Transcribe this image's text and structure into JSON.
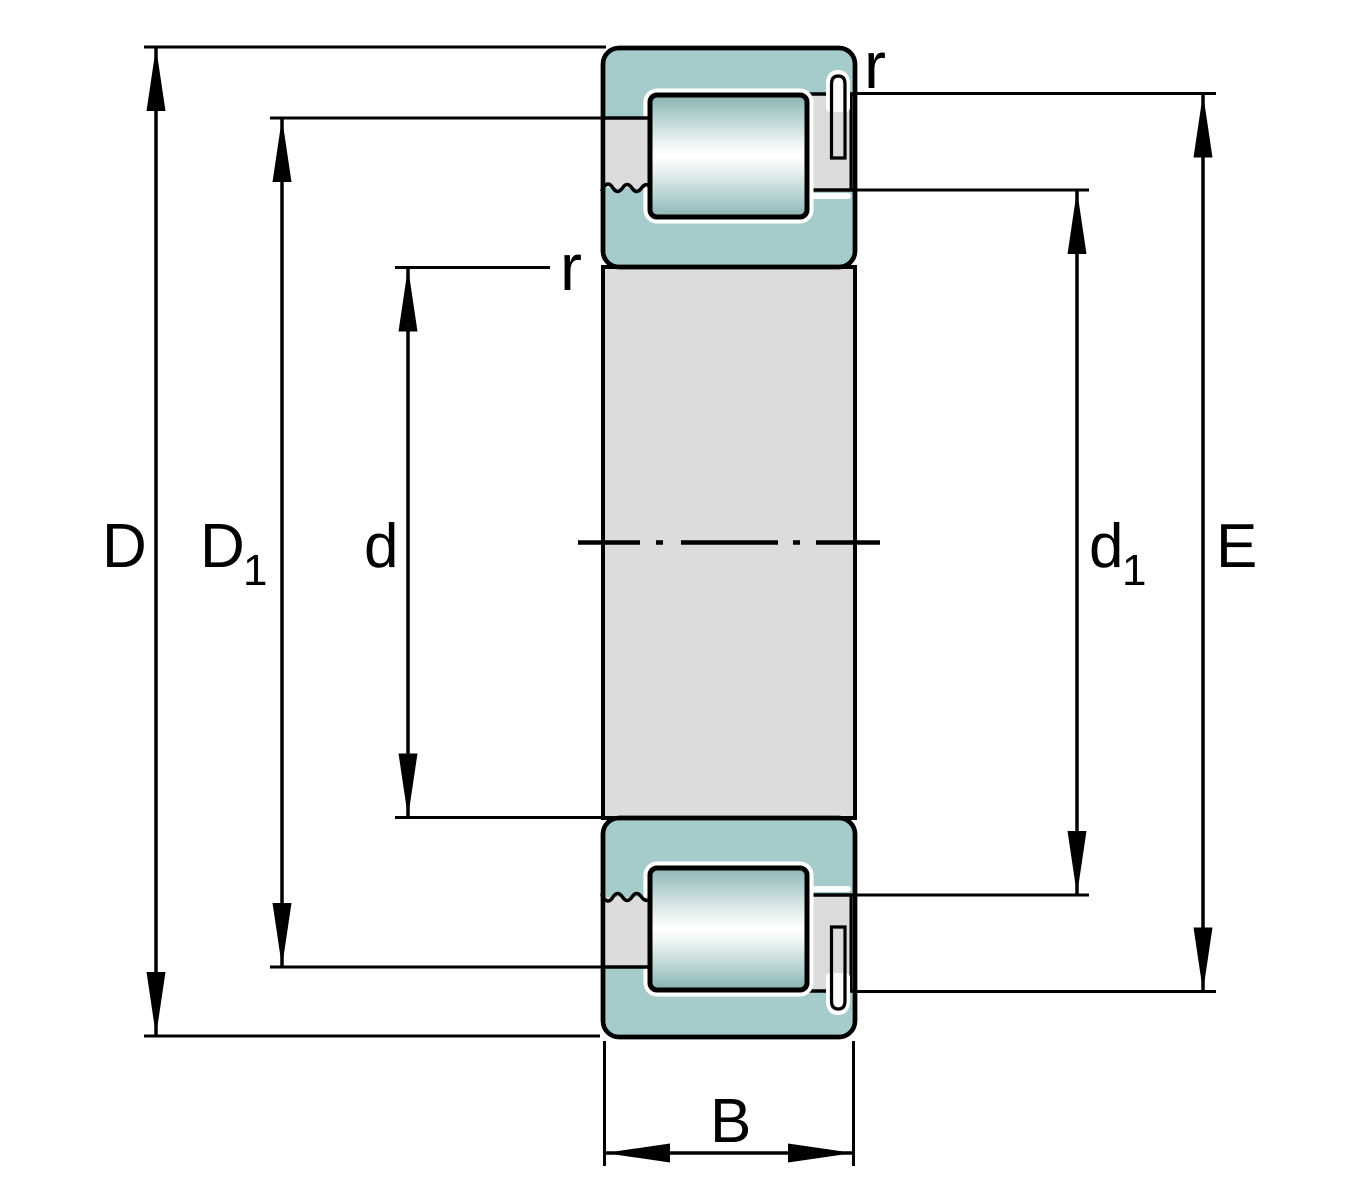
{
  "figure": {
    "title": "Cylindrical roller bearing cross-section dimension drawing",
    "labels": {
      "outer_diameter": "D",
      "outer_shoulder_base": "D",
      "outer_shoulder_sub": "1",
      "bore_diameter": "d",
      "inner_shoulder_base": "d",
      "inner_shoulder_sub": "1",
      "raceway_diameter": "E",
      "width": "B",
      "fillet_radius": "r"
    },
    "colors": {
      "ring_teal": "#a5cccb",
      "steel_gray": "#dcdcdc",
      "pin_gray": "#dcdcdc",
      "outline": "#000000",
      "background": "#ffffff"
    }
  }
}
